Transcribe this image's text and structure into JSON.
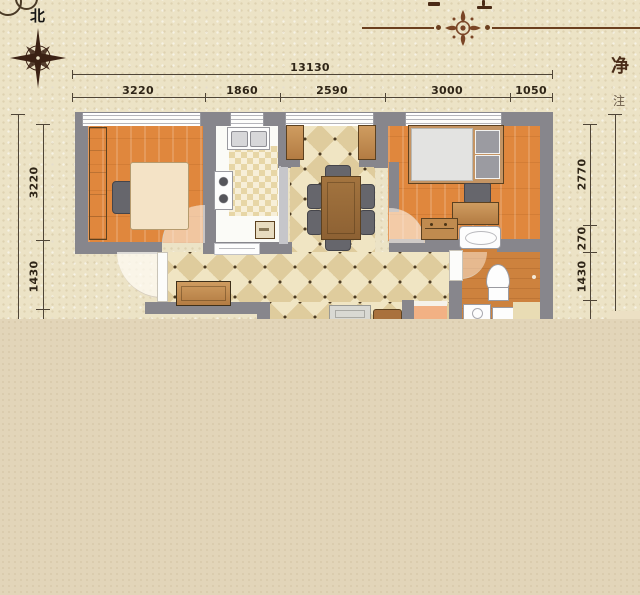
{
  "decor": {
    "north_label": "北",
    "right_text_primary": "净",
    "right_text_secondary": "注"
  },
  "dimensions": {
    "top_total": "13130",
    "top_segments": [
      "3220",
      "1860",
      "2590",
      "3000",
      "1050"
    ],
    "left_segments": [
      "3220",
      "1430"
    ],
    "right_segments": [
      "2770",
      "270",
      "1430"
    ]
  },
  "colors": {
    "paper": "#ece3c6",
    "band": "#e2d5b9",
    "wall": "#87868c",
    "wood_floor": "#e0873d",
    "bath_floor": "#cd823e",
    "kitchen_floor": "#fbfbf7",
    "checker": "#e7d6a6",
    "tile_light": "#f0e5c3",
    "tile_dark": "#dfcc9d",
    "dot": "#4a3a22",
    "dim_line": "#4f4537",
    "ink": "#2f2517",
    "accent_brown": "#6b3f1f",
    "furn_border": "#5c4120",
    "chair_gray": "#66666c",
    "fixture_white": "#fdfdfd"
  }
}
